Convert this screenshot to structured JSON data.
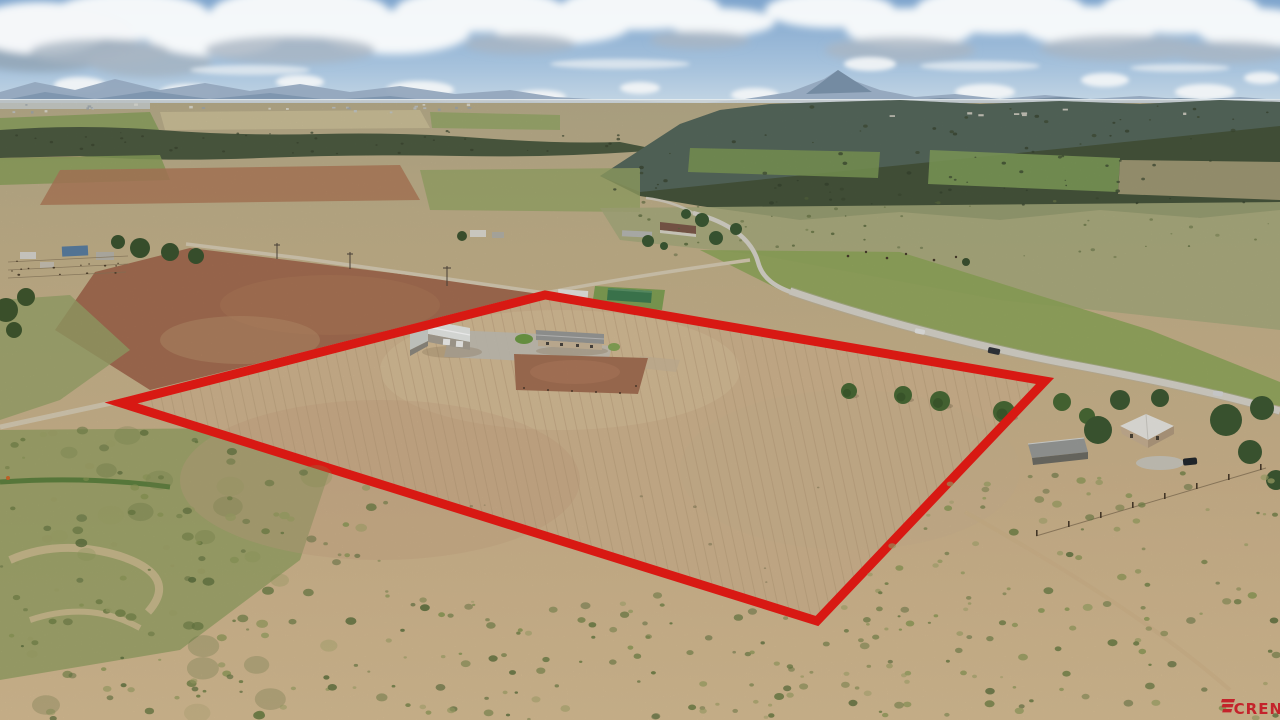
{
  "watermark": {
    "brand": "CREN"
  },
  "boundary": {
    "color": "#ef1c15"
  },
  "palette": {
    "sky": "#8fb0d3",
    "cloud": "#f8fafb",
    "mountain_haze": "#8aa0b8",
    "forest_dark": "#47563c",
    "field_tan": "#c9b089",
    "pasture_green": "#8fa15f",
    "dirt_red_brown": "#a26d50",
    "paved_road": "#d9d6cc",
    "dirt_road": "#d8cdb4",
    "watermark_red": "#c4232b"
  }
}
